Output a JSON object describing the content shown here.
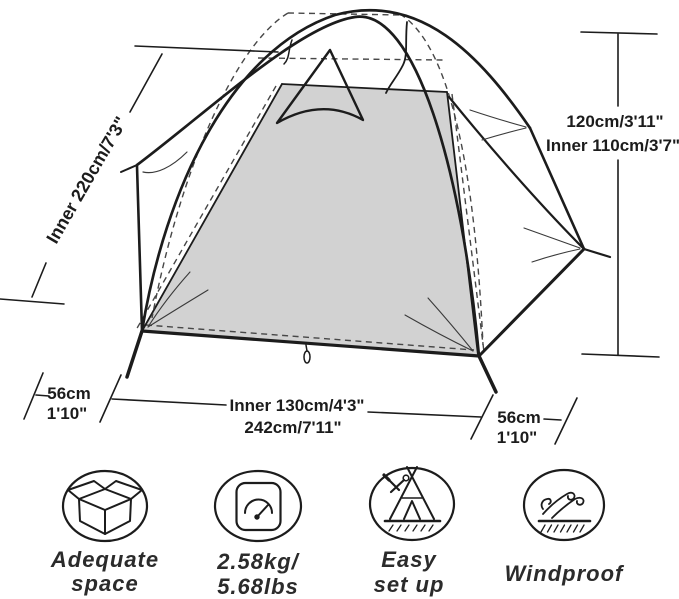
{
  "diagram_title": "tent-dimensions-infographic",
  "dimensions": {
    "slant_label": "Inner 220cm/7'3\"",
    "height_label": "120cm/3'11\"",
    "inner_height_label": "Inner 110cm/3'7\"",
    "left_depth_cm": "56cm",
    "left_depth_ft": "1'10\"",
    "inner_width_label": "Inner 130cm/4'3\"",
    "outer_width_label": "242cm/7'11\"",
    "right_depth_cm": "56cm",
    "right_depth_ft": "1'10\""
  },
  "features": [
    {
      "icon": "open-box-icon",
      "line1": "Adequate",
      "line2": "space"
    },
    {
      "icon": "weight-scale-icon",
      "line1": "2.58kg/",
      "line2": "5.68lbs"
    },
    {
      "icon": "tent-setup-icon",
      "line1": "Easy",
      "line2": "set up"
    },
    {
      "icon": "windproof-icon",
      "line1": "Windproof",
      "line2": ""
    }
  ],
  "colors": {
    "ink": "#1c1c1c",
    "panel_fill": "#d2d2d2",
    "background": "#ffffff"
  }
}
